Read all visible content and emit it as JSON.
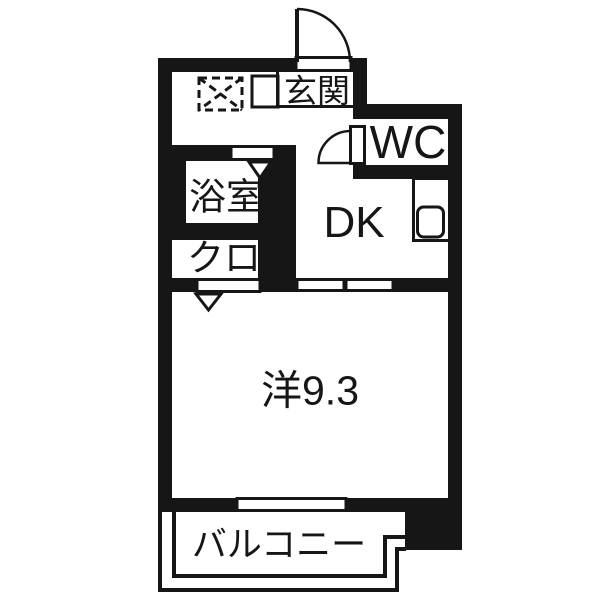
{
  "plan": {
    "type": "apartment-floor-plan",
    "background_color": "#ffffff",
    "wall_color": "#161616"
  },
  "rooms": {
    "genkan": {
      "label": "玄関"
    },
    "wc": {
      "label": "WC"
    },
    "bathroom": {
      "label": "浴室"
    },
    "closet": {
      "label": "クロ"
    },
    "dk": {
      "label": "DK"
    },
    "western_room": {
      "label": "洋9.3",
      "area_tatami": 9.3
    },
    "balcony": {
      "label": "バルコニー"
    }
  },
  "symbols": {
    "entrance_door": "quarter-arc-swing-door",
    "wc_door": "quarter-arc-swing-door",
    "bathroom_door_marker": "triangle-down-opening",
    "room_entry_marker": "triangle-down-opening",
    "appliance_space": "dashed-box-with-x",
    "shoe_cabinet": "small-square",
    "kitchen_counter": "counter-outline",
    "kitchen_sink": "rounded-square",
    "sliding_door": "two-white-panels-in-wall",
    "window": "white-opening-in-wall",
    "genkan_step": "thin-corner-line",
    "balcony_rail": "double-thin-outline"
  }
}
